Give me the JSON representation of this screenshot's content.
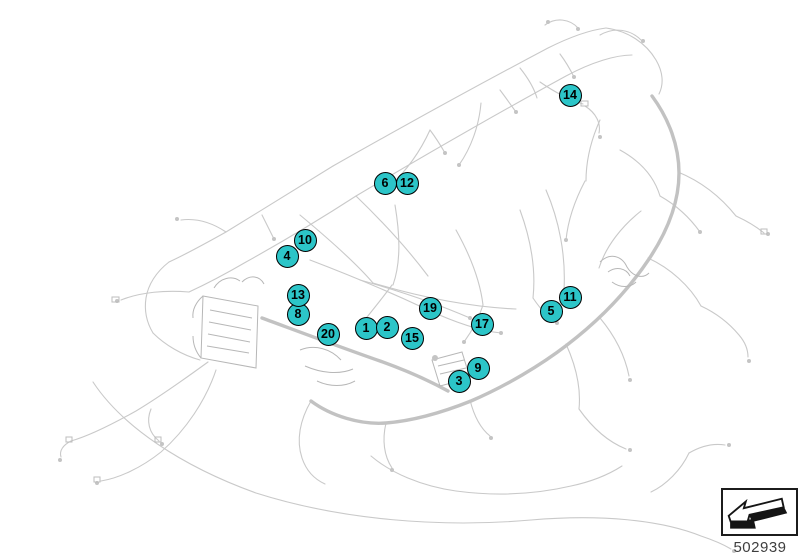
{
  "diagram": {
    "title": "vehicle-wiring-harness-connection-points",
    "number": "502939",
    "callout_color": "#2cc5c8",
    "callout_border_color": "#000000",
    "harness_color": "#c9c9c9",
    "callouts": [
      {
        "label": "1",
        "x": 366,
        "y": 328
      },
      {
        "label": "2",
        "x": 387,
        "y": 327
      },
      {
        "label": "3",
        "x": 459,
        "y": 381
      },
      {
        "label": "4",
        "x": 287,
        "y": 256
      },
      {
        "label": "5",
        "x": 551,
        "y": 311
      },
      {
        "label": "6",
        "x": 385,
        "y": 183
      },
      {
        "label": "8",
        "x": 298,
        "y": 314
      },
      {
        "label": "9",
        "x": 478,
        "y": 368
      },
      {
        "label": "10",
        "x": 305,
        "y": 240
      },
      {
        "label": "11",
        "x": 570,
        "y": 297
      },
      {
        "label": "12",
        "x": 407,
        "y": 183
      },
      {
        "label": "13",
        "x": 298,
        "y": 295
      },
      {
        "label": "14",
        "x": 570,
        "y": 95
      },
      {
        "label": "15",
        "x": 412,
        "y": 338
      },
      {
        "label": "17",
        "x": 482,
        "y": 324
      },
      {
        "label": "19",
        "x": 430,
        "y": 308
      },
      {
        "label": "20",
        "x": 328,
        "y": 334
      }
    ]
  },
  "stamp": {
    "number": "502939",
    "icon": "arrow-down-left-3d"
  }
}
